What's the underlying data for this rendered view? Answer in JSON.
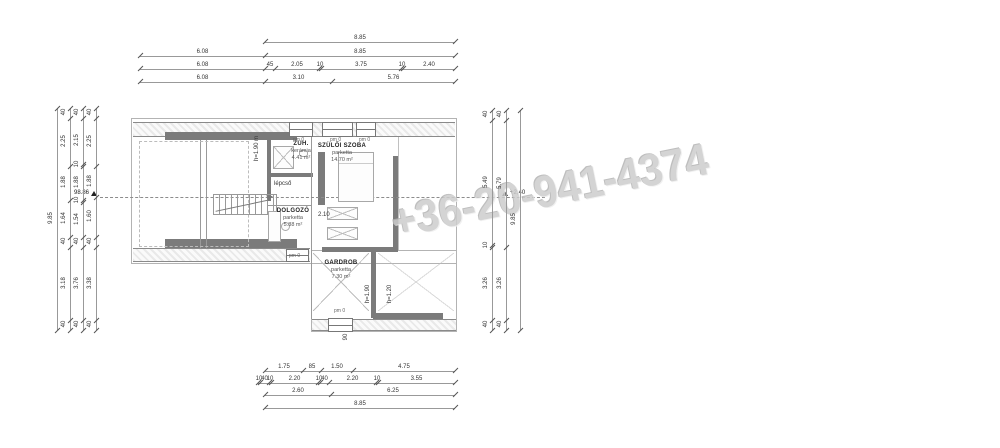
{
  "watermark": "+36-20-941-4374",
  "colors": {
    "watermark": "#cdcdcd",
    "wall_dark": "#7b7b7b",
    "wall_hatch": "#e9e9e9",
    "line": "#999999"
  },
  "rooms": [
    {
      "name": "ZUH.",
      "material": "kerámia",
      "area": "4.41 m²"
    },
    {
      "name": "SZÜLŐI SZOBA",
      "material": "parketta",
      "area": "14.70 m²"
    },
    {
      "name": "DOLGOZÓ",
      "material": "parketta",
      "area": "5.88 m²"
    },
    {
      "name": "GARDROB",
      "material": "parketta",
      "area": "7.30 m²"
    }
  ],
  "levels": {
    "left": "98.86",
    "right": "+2,40"
  },
  "pm": {
    "text": "pm 0",
    "positions": [
      {
        "x": 293,
        "y": 138
      },
      {
        "x": 330,
        "y": 138
      },
      {
        "x": 359,
        "y": 138
      },
      {
        "x": 289,
        "y": 254
      },
      {
        "x": 334,
        "y": 309
      }
    ]
  },
  "texts": [
    {
      "t": "lépcső",
      "x": 274,
      "y": 181
    },
    {
      "t": "2.10",
      "x": 318,
      "y": 212
    }
  ],
  "rot_texts": [
    {
      "t": "h=1.90 m",
      "x": 257,
      "y": 150
    },
    {
      "t": "h=1.90",
      "x": 368,
      "y": 295
    },
    {
      "t": "h=1.20",
      "x": 390,
      "y": 295
    },
    {
      "t": "90",
      "x": 346,
      "y": 338
    }
  ],
  "dims": {
    "horizontal": [
      {
        "y": 42,
        "segs": [
          {
            "a": 265,
            "b": 455,
            "t": "8.85"
          }
        ]
      },
      {
        "y": 56,
        "segs": [
          {
            "a": 140,
            "b": 265,
            "t": "6.08"
          },
          {
            "a": 265,
            "b": 455,
            "t": "8.85"
          }
        ]
      },
      {
        "y": 69,
        "segs": [
          {
            "a": 140,
            "b": 265,
            "t": "6.08"
          },
          {
            "a": 265,
            "b": 275,
            "t": "45"
          },
          {
            "a": 275,
            "b": 319,
            "t": "2.05"
          },
          {
            "a": 319,
            "b": 321,
            "t": "10"
          },
          {
            "a": 321,
            "b": 401,
            "t": "3.75"
          },
          {
            "a": 401,
            "b": 403,
            "t": "10"
          },
          {
            "a": 403,
            "b": 455,
            "t": "2.40"
          }
        ]
      },
      {
        "y": 82,
        "segs": [
          {
            "a": 140,
            "b": 265,
            "t": "6.08"
          },
          {
            "a": 265,
            "b": 332,
            "t": "3.10"
          },
          {
            "a": 332,
            "b": 455,
            "t": "5.76"
          }
        ]
      },
      {
        "y": 371,
        "segs": [
          {
            "a": 265,
            "b": 303,
            "t": "1.75"
          },
          {
            "a": 303,
            "b": 321,
            "t": "85"
          },
          {
            "a": 321,
            "b": 353,
            "t": "1.50"
          },
          {
            "a": 353,
            "b": 455,
            "t": "4.75"
          }
        ]
      },
      {
        "y": 383,
        "segs": [
          {
            "a": 258,
            "b": 260,
            "t": "10"
          },
          {
            "a": 260,
            "b": 269,
            "t": "40"
          },
          {
            "a": 269,
            "b": 271,
            "t": "10"
          },
          {
            "a": 271,
            "b": 318,
            "t": "2.20"
          },
          {
            "a": 318,
            "b": 320,
            "t": "10"
          },
          {
            "a": 320,
            "b": 329,
            "t": "40"
          },
          {
            "a": 329,
            "b": 376,
            "t": "2.20"
          },
          {
            "a": 376,
            "b": 378,
            "t": "10"
          },
          {
            "a": 378,
            "b": 455,
            "t": "3.55"
          }
        ]
      },
      {
        "y": 395,
        "segs": [
          {
            "a": 265,
            "b": 331,
            "t": "2.60"
          },
          {
            "a": 331,
            "b": 455,
            "t": "6.25"
          }
        ]
      },
      {
        "y": 408,
        "segs": [
          {
            "a": 265,
            "b": 455,
            "t": "8.85"
          }
        ]
      }
    ],
    "vertical": [
      {
        "x": 57,
        "segs": [
          {
            "a": 108,
            "b": 330,
            "t": "9.85"
          }
        ]
      },
      {
        "x": 70,
        "segs": [
          {
            "a": 108,
            "b": 118,
            "t": "40"
          },
          {
            "a": 118,
            "b": 166,
            "t": "2.25"
          },
          {
            "a": 166,
            "b": 200,
            "t": "1.88"
          },
          {
            "a": 200,
            "b": 237,
            "t": "1.64"
          },
          {
            "a": 237,
            "b": 247,
            "t": "40"
          },
          {
            "a": 247,
            "b": 320,
            "t": "3.18"
          },
          {
            "a": 320,
            "b": 330,
            "t": "40"
          }
        ]
      },
      {
        "x": 83,
        "segs": [
          {
            "a": 108,
            "b": 118,
            "t": "40"
          },
          {
            "a": 118,
            "b": 164,
            "t": "2.15"
          },
          {
            "a": 164,
            "b": 166,
            "t": "10"
          },
          {
            "a": 166,
            "b": 200,
            "t": "1.88"
          },
          {
            "a": 200,
            "b": 202,
            "t": "10"
          },
          {
            "a": 202,
            "b": 237,
            "t": "1.54"
          },
          {
            "a": 237,
            "b": 247,
            "t": "40"
          },
          {
            "a": 247,
            "b": 320,
            "t": "3.76"
          },
          {
            "a": 320,
            "b": 330,
            "t": "40"
          }
        ]
      },
      {
        "x": 96,
        "segs": [
          {
            "a": 108,
            "b": 118,
            "t": "40"
          },
          {
            "a": 118,
            "b": 166,
            "t": "2.25"
          },
          {
            "a": 166,
            "b": 197,
            "t": "1.88"
          },
          {
            "a": 197,
            "b": 237,
            "t": "1.60"
          },
          {
            "a": 237,
            "b": 247,
            "t": "40"
          },
          {
            "a": 247,
            "b": 320,
            "t": "3.38"
          },
          {
            "a": 320,
            "b": 330,
            "t": "40"
          }
        ]
      },
      {
        "x": 492,
        "segs": [
          {
            "a": 110,
            "b": 120,
            "t": "40"
          },
          {
            "a": 120,
            "b": 245,
            "t": "5.49"
          },
          {
            "a": 245,
            "b": 247,
            "t": "10"
          },
          {
            "a": 247,
            "b": 320,
            "t": "3.26"
          },
          {
            "a": 320,
            "b": 330,
            "t": "40"
          }
        ]
      },
      {
        "x": 506,
        "segs": [
          {
            "a": 110,
            "b": 120,
            "t": "40"
          },
          {
            "a": 120,
            "b": 247,
            "t": "5.79"
          },
          {
            "a": 247,
            "b": 320,
            "t": "3.26"
          },
          {
            "a": 320,
            "b": 330,
            "t": "40"
          }
        ]
      },
      {
        "x": 520,
        "segs": [
          {
            "a": 110,
            "b": 330,
            "t": "9.85"
          }
        ]
      }
    ]
  }
}
